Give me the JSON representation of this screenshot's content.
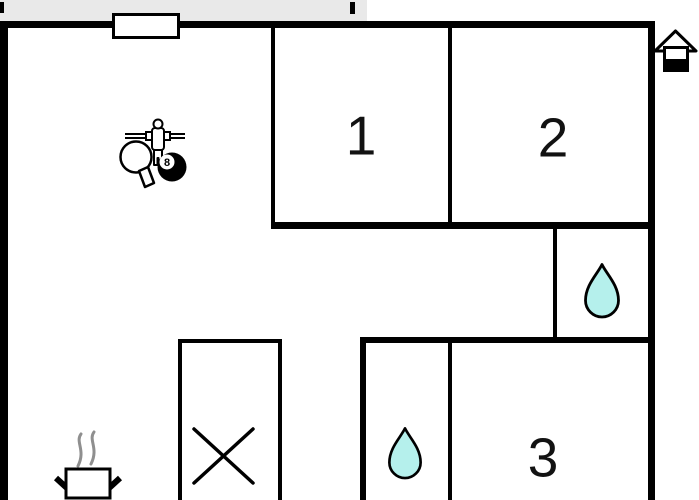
{
  "colors": {
    "wall": "#000000",
    "terrace": "#e9e9e9",
    "water": "#b5f0ec",
    "steam": "#8f8f8f"
  },
  "rooms": [
    {
      "label": "1"
    },
    {
      "label": "2"
    },
    {
      "label": "3"
    }
  ],
  "icons": {
    "eight_ball_text": "8",
    "game_area": [
      "foosball-player-icon",
      "table-tennis-paddle-icon",
      "eight-ball-icon"
    ],
    "bathroom_upper": "water-drop-icon",
    "bathroom_lower": "water-drop-icon",
    "kitchen": "cooking-pot-icon",
    "entrance_marker": "house-icon",
    "crossed_area": "x-mark",
    "top_opening": "window-marker",
    "outdoor_strip": "terrace"
  }
}
